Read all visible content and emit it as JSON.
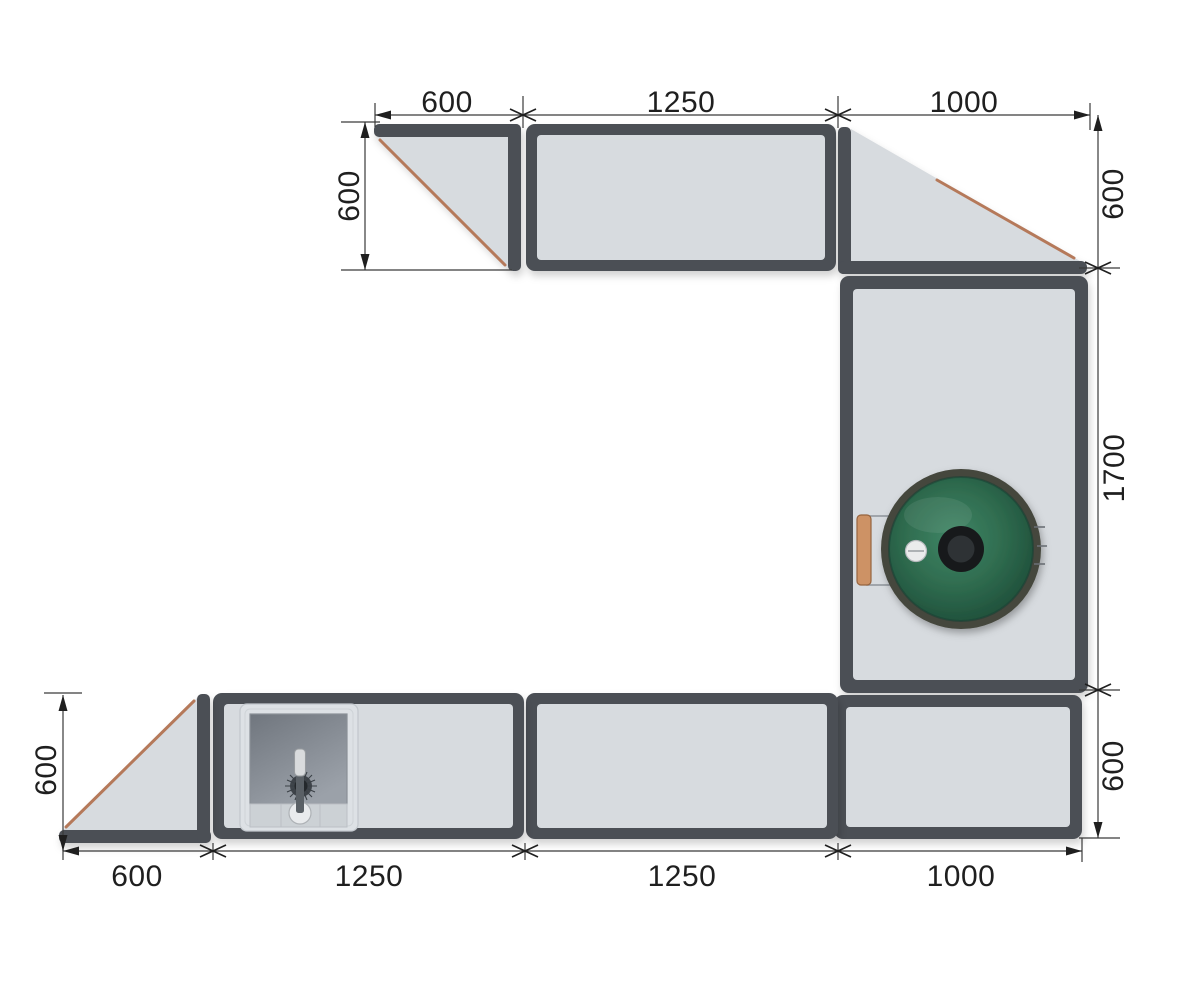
{
  "drawing": {
    "view": "outdoor-kitchen-plan-top-view",
    "shape": "U-shaped counter with grill and sink"
  },
  "dims": {
    "top": [
      "600",
      "1250",
      "1000"
    ],
    "left_top": "600",
    "right_top": "600",
    "right_middle": "1700",
    "right_bottom": "600",
    "left_bottom": "600",
    "bottom": [
      "600",
      "1250",
      "1250",
      "1000"
    ]
  },
  "modules": [
    {
      "id": "corner-left-top",
      "type": "triangle-end",
      "labels": [
        "600",
        "600"
      ]
    },
    {
      "id": "straight-top",
      "type": "straight",
      "labels": [
        "1250"
      ]
    },
    {
      "id": "diagonal-right-top",
      "type": "diagonal-transition",
      "labels": [
        "1000",
        "600"
      ]
    },
    {
      "id": "grill-module",
      "type": "straight-with-kamado-grill",
      "labels": [
        "1700"
      ]
    },
    {
      "id": "corner-right-bottom",
      "type": "straight",
      "labels": [
        "1000",
        "600"
      ]
    },
    {
      "id": "straight-bottom",
      "type": "straight",
      "labels": [
        "1250"
      ]
    },
    {
      "id": "sink-module",
      "type": "straight-with-sink",
      "labels": [
        "1250"
      ]
    },
    {
      "id": "corner-left-bottom",
      "type": "triangle-end",
      "labels": [
        "600",
        "600"
      ]
    }
  ],
  "colors": {
    "background": "#ffffff",
    "frame": "#4b4f55",
    "countertop": "#d7dbdf",
    "wood_edge": "#b5795a",
    "grill_rim": "#44463c",
    "grill_green_light": "#3f8565",
    "grill_green": "#2f6c4f",
    "grill_green_dark": "#1f4f3a",
    "knob_outer": "#17191b",
    "knob_inner": "#2e3235",
    "thermometer": "#ebecec",
    "thermometer_line": "#9fa3a6",
    "handle_wood": "#cd9265",
    "handle_wood_stroke": "#96643f",
    "bracket": "#8d939a",
    "sink_panel": "#dde1e5",
    "sink_panel_stroke": "#c3c8cd",
    "sink_basin_dark": "#70767e",
    "sink_basin_light": "#9ba1a9",
    "sink_apron": "#ccd1d5",
    "sink_apron_stroke": "#bbc0c5",
    "sink_knob": "#e9ebed",
    "drain": "#3f444a",
    "faucet_stem": "#5a6066",
    "faucet_handle": "#d9dbdd",
    "dimension": "#1f1f1f",
    "extension": "#3a3a3a"
  }
}
